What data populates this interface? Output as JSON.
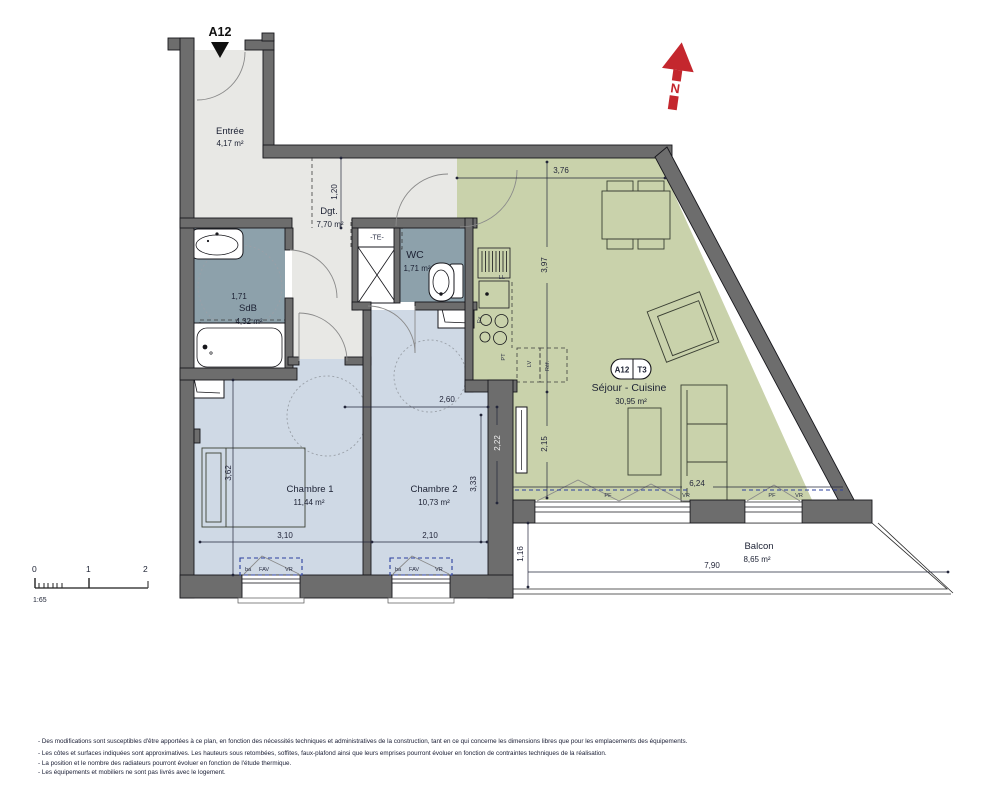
{
  "plan": {
    "unit_title": "A12",
    "badge": {
      "unit": "A12",
      "type": "T3"
    },
    "north_label": "N",
    "rooms": {
      "entree": {
        "name": "Entrée",
        "area": "4,17 m²"
      },
      "dgt": {
        "name": "Dgt.",
        "area": "7,70 m²"
      },
      "sdb": {
        "name": "SdB",
        "area": "4,32 m²",
        "width_dim": "1,71"
      },
      "wc": {
        "name": "WC",
        "area": "1,71 m²"
      },
      "sejour": {
        "name": "Séjour - Cuisine",
        "area": "30,95 m²"
      },
      "chambre1": {
        "name": "Chambre 1",
        "area": "11,44 m²"
      },
      "chambre2": {
        "name": "Chambre 2",
        "area": "10,73 m²"
      },
      "balcon": {
        "name": "Balcon",
        "area": "8,65 m²"
      }
    },
    "dimensions": {
      "sejour_top": "3,76",
      "sejour_kitchen": "3,97",
      "sejour_lower": "2,15",
      "sejour_bottom": "6,24",
      "dgt_height": "1,20",
      "ch2_top": "2,60",
      "ch2_right": "2,22",
      "ch2_height": "3,33",
      "ch1_height": "3,62",
      "ch1_width": "3,10",
      "ch2_width": "2,10",
      "balcon_depth": "1,16",
      "balcon_width": "7,90"
    },
    "annotations": {
      "te": "-TE-",
      "ll": "LL",
      "ev": "Ev",
      "pt": "PT",
      "lv": "LV",
      "ref": "Réf.",
      "pf": "PF",
      "vr": "VR",
      "ba": "ba",
      "fav": "FAV"
    },
    "scale": {
      "zero": "0",
      "one": "1",
      "two": "2",
      "ratio": "1:65"
    },
    "footer": [
      "- Des modifications sont susceptibles d'être apportées à ce plan, en fonction des nécessités techniques et administratives de la construction, tant en ce qui concerne les dimensions libres que pour les emplacements des équipements.",
      "- Les côtes et surfaces indiquées sont approximatives. Les hauteurs sous retombées, soffites, faux-plafond ainsi que leurs emprises pourront évoluer en fonction de contraintes techniques de la réalisation.",
      "- La position et le nombre des radiateurs pourront évoluer en fonction de l'étude thermique.",
      "- Les équipements et mobiliers ne sont pas livrés avec le logement."
    ]
  }
}
